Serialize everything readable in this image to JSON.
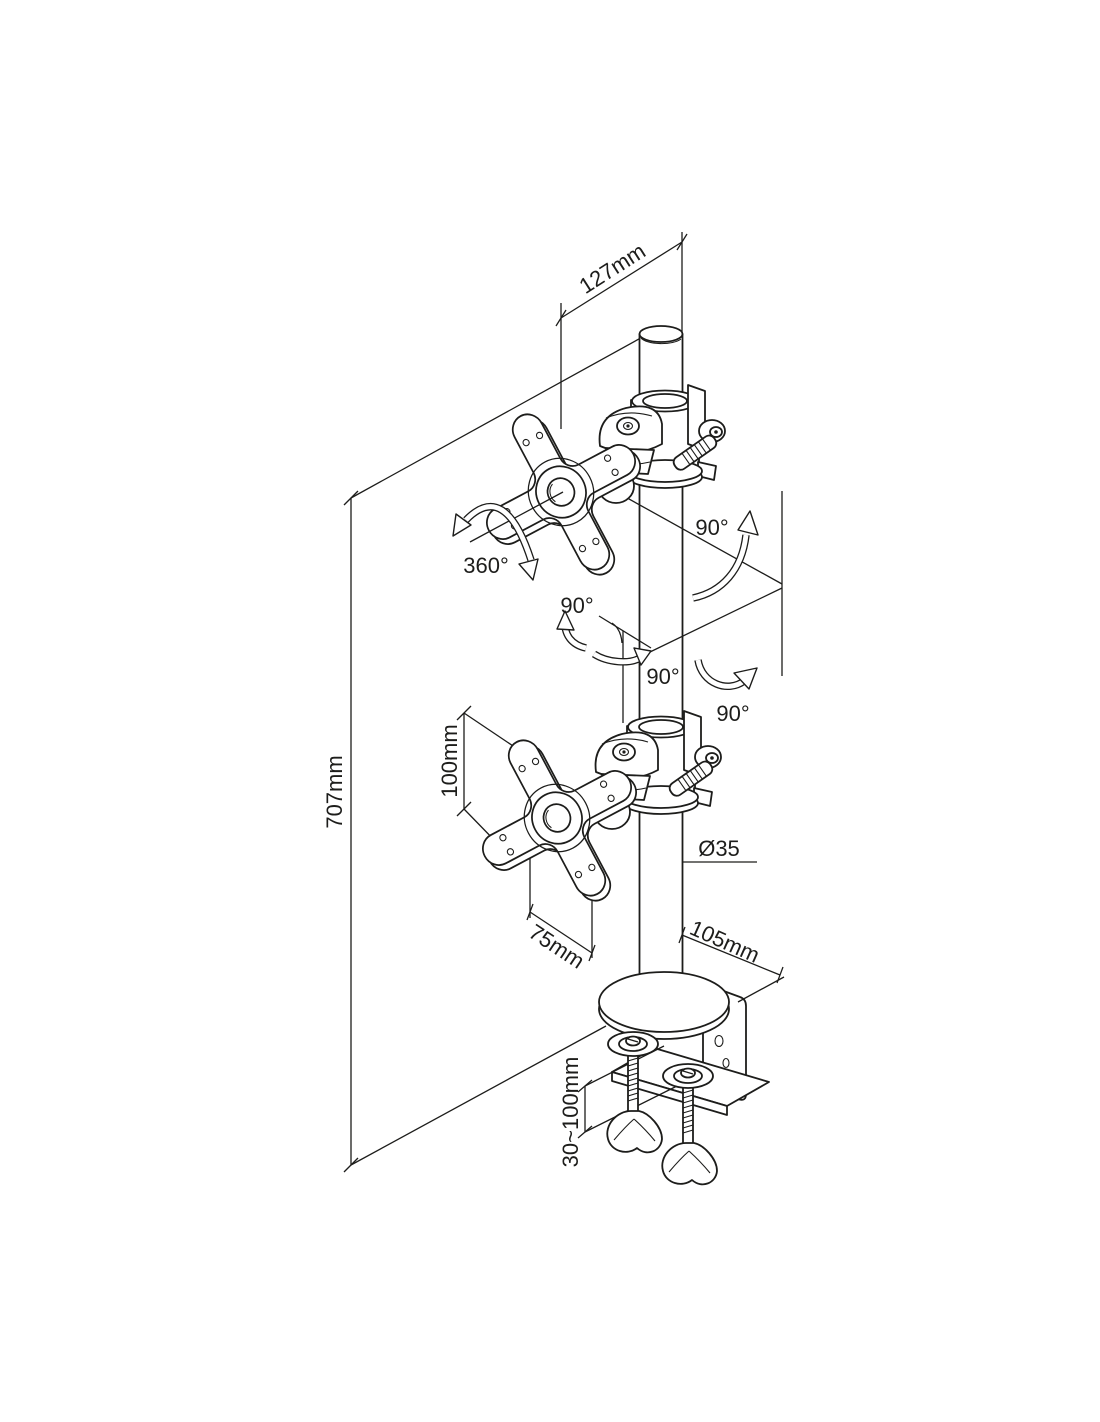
{
  "page": {
    "background_color": "#ffffff",
    "line_color": "#1d1d1b"
  },
  "diagram": {
    "type": "technical-drawing",
    "subject": "Dual monitor desk-mount pole with two VESA plates and desk clamp, isometric dimension drawing",
    "labels": {
      "arm_length": "127mm",
      "rotation": "360°",
      "swivel_top": "90°",
      "tilt_mid": "90°",
      "pan_mid": "90°",
      "swivel_bottom": "90°",
      "vesa_height": "100mm",
      "vesa_width": "75mm",
      "total_height": "707mm",
      "pole_diameter": "Ø35",
      "clamp_depth": "105mm",
      "clamp_range": "30~100mm"
    }
  }
}
